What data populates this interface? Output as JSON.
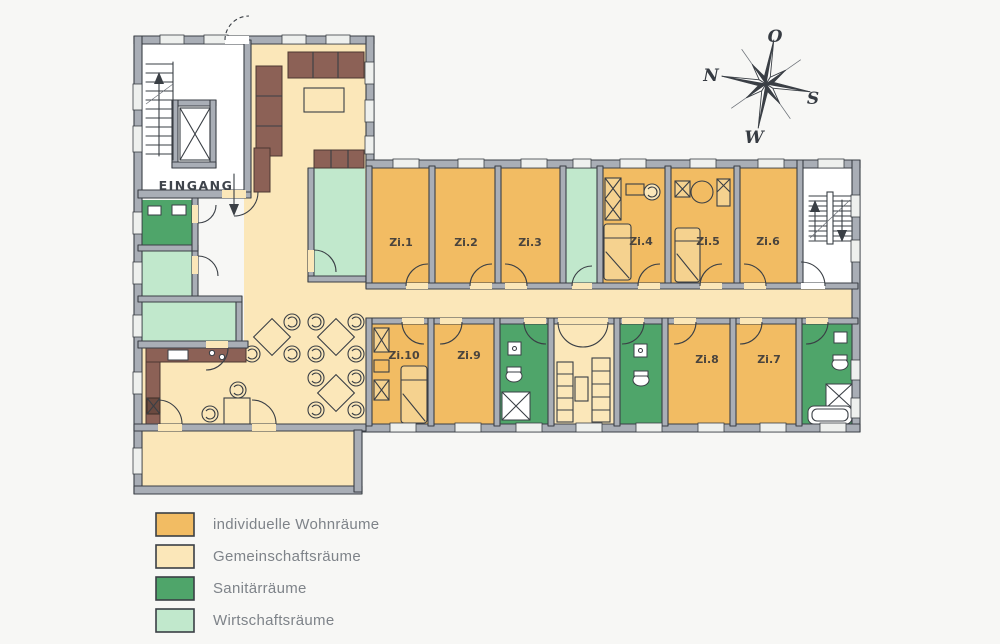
{
  "colors": {
    "individual": "#F2BC63",
    "community": "#FBE7B9",
    "sanitary": "#4FA56A",
    "utility": "#C1E8CC",
    "wall": "#A9AEB6",
    "line": "#3A3F45",
    "furniture": "#8C6156",
    "furniture_light": "#F5D28F",
    "background": "#F7F7F5"
  },
  "entrance": {
    "label": "EINGANG"
  },
  "rooms": [
    {
      "id": "zi1",
      "label": "Zi.1"
    },
    {
      "id": "zi2",
      "label": "Zi.2"
    },
    {
      "id": "zi3",
      "label": "Zi.3"
    },
    {
      "id": "zi4",
      "label": "Zi.4"
    },
    {
      "id": "zi5",
      "label": "Zi.5"
    },
    {
      "id": "zi6",
      "label": "Zi.6"
    },
    {
      "id": "zi7",
      "label": "Zi.7"
    },
    {
      "id": "zi8",
      "label": "Zi.8"
    },
    {
      "id": "zi9",
      "label": "Zi.9"
    },
    {
      "id": "zi10",
      "label": "Zi.10"
    }
  ],
  "compass": {
    "top": "O",
    "left": "N",
    "right": "S",
    "bottom": "W"
  },
  "legend": {
    "items": [
      {
        "label": "individuelle Wohnräume",
        "color": "#F2BC63"
      },
      {
        "label": "Gemeinschaftsräume",
        "color": "#FBE7B9"
      },
      {
        "label": "Sanitärräume",
        "color": "#4FA56A"
      },
      {
        "label": "Wirtschaftsräume",
        "color": "#C1E8CC"
      }
    ]
  }
}
